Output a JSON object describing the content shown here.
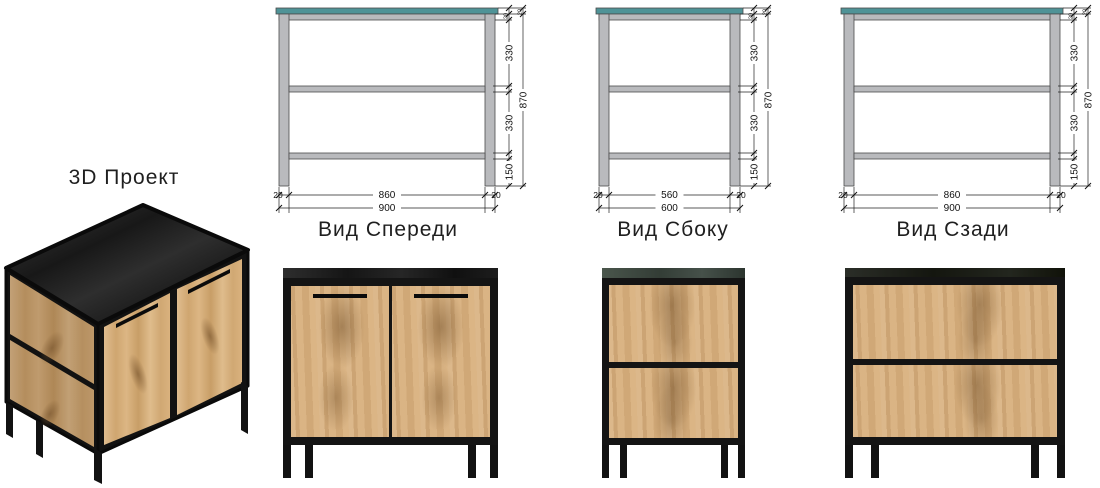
{
  "project_label": "3D Проект",
  "views": {
    "front": {
      "label": "Вид Спереди",
      "width_inner": "860",
      "width_outer": "900",
      "leg_thickness": "20",
      "gap_top": "330",
      "gap_middle": "330",
      "leg_height": "150",
      "frame_height": "870",
      "top_thickness": "20"
    },
    "side": {
      "label": "Вид Сбоку",
      "width_inner": "560",
      "width_outer": "600",
      "leg_thickness": "20",
      "gap_top": "330",
      "gap_middle": "330",
      "leg_height": "150",
      "frame_height": "870",
      "top_thickness": "20"
    },
    "rear": {
      "label": "Вид Сзади",
      "width_inner": "860",
      "width_outer": "900",
      "leg_thickness": "20",
      "gap_top": "330",
      "gap_middle": "330",
      "leg_height": "150",
      "frame_height": "870",
      "top_thickness": "20"
    }
  },
  "colors": {
    "tabletop_teal": "#4f9397",
    "frame_gray": "#b9babd",
    "wood": "#d8b07e",
    "metal_black": "#141414",
    "stone_top": "#242424"
  }
}
